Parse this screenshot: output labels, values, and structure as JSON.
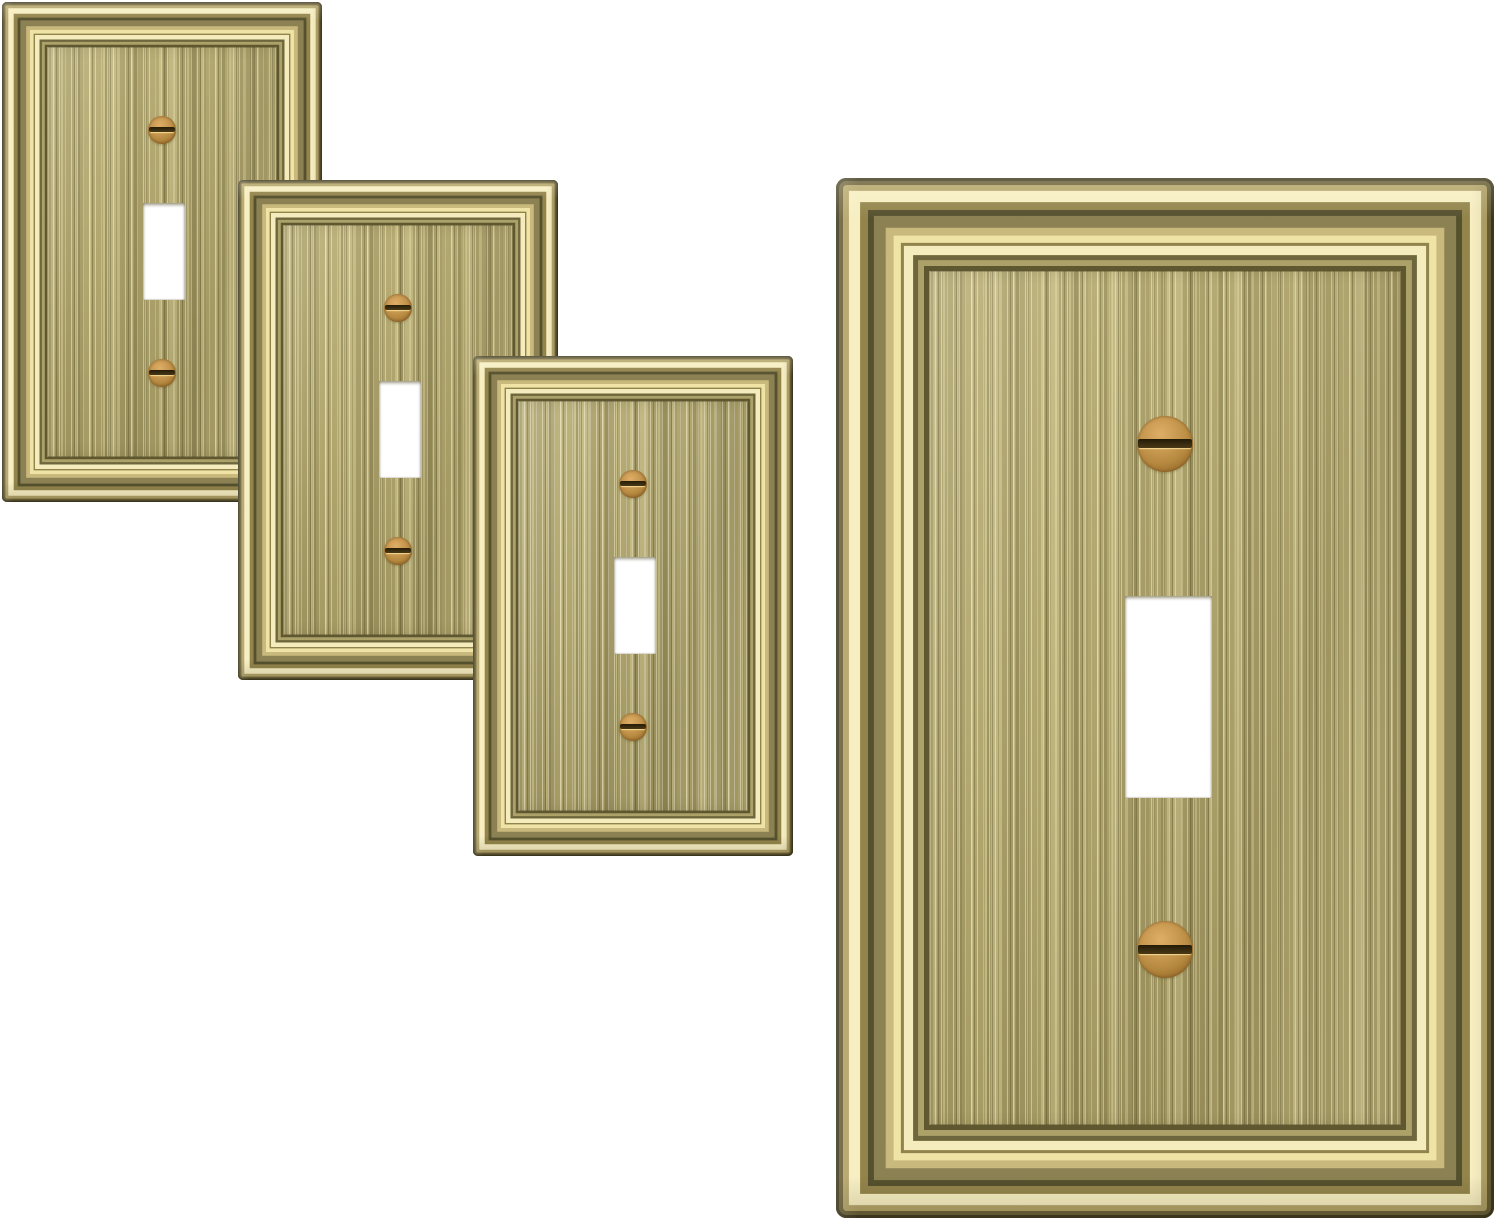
{
  "scene": {
    "description": "Product photo: four antique brass single-toggle switch wall plates with stepped picture-frame molding, brushed vertical-grain center panel, white toggle cutout and two copper slotted screws; three small plates cascade diagonally at upper left, one large plate stands at the right.",
    "background_color": "#ffffff",
    "palette": {
      "background": "#ffffff",
      "field_base": "#b1a66e",
      "field_light": "#b8ad76",
      "field_dark": "#a89d66",
      "gold_peak": "#f7eec2",
      "gold_mid": "#b4a469",
      "gold_shadow": "#6e663c",
      "olive_groove": "#55502e",
      "screw_copper": "#c6974f",
      "screw_bright": "#dfae66",
      "screw_rim": "#7c5620",
      "screw_slot": "#4a3916"
    },
    "plates": [
      {
        "name": "wall-plate-small-1",
        "x": 2,
        "y": 2,
        "width": 320,
        "height": 500,
        "z": 1
      },
      {
        "name": "wall-plate-small-2",
        "x": 238,
        "y": 180,
        "width": 320,
        "height": 500,
        "z": 2
      },
      {
        "name": "wall-plate-small-3",
        "x": 473,
        "y": 356,
        "width": 320,
        "height": 500,
        "z": 3
      },
      {
        "name": "wall-plate-large",
        "x": 836,
        "y": 178,
        "width": 658,
        "height": 1040,
        "z": 1
      }
    ],
    "plate_geometry": {
      "corner_radius_ratio": 0.016,
      "toggle_cutout": {
        "left": 0.439,
        "top": 0.402,
        "width": 0.133,
        "height": 0.194
      },
      "screw_top": {
        "cx": 0.5,
        "cy": 0.256,
        "d": 0.086
      },
      "screw_bottom": {
        "cx": 0.5,
        "cy": 0.742,
        "d": 0.086
      }
    },
    "frame_bands": [
      {
        "w": 0.0046,
        "color": "#3e3820"
      },
      {
        "w": 0.006,
        "color": "#6a6038"
      },
      {
        "w": 0.009,
        "color": "#b4a469"
      },
      {
        "w": 0.017,
        "color": "#f7eec2"
      },
      {
        "w": 0.012,
        "color": "#93844b"
      },
      {
        "w": 0.009,
        "color": "#55502e"
      },
      {
        "w": 0.018,
        "color": "#8b8152"
      },
      {
        "w": 0.012,
        "color": "#c9b97c"
      },
      {
        "w": 0.011,
        "color": "#f0e3a6"
      },
      {
        "w": 0.0046,
        "color": "#91834c"
      },
      {
        "w": 0.014,
        "color": "#f5ecbe"
      },
      {
        "w": 0.0076,
        "color": "#6e663c"
      },
      {
        "w": 0.009,
        "color": "#aca168"
      },
      {
        "w": 0.0076,
        "color": "#5e572f"
      }
    ]
  }
}
